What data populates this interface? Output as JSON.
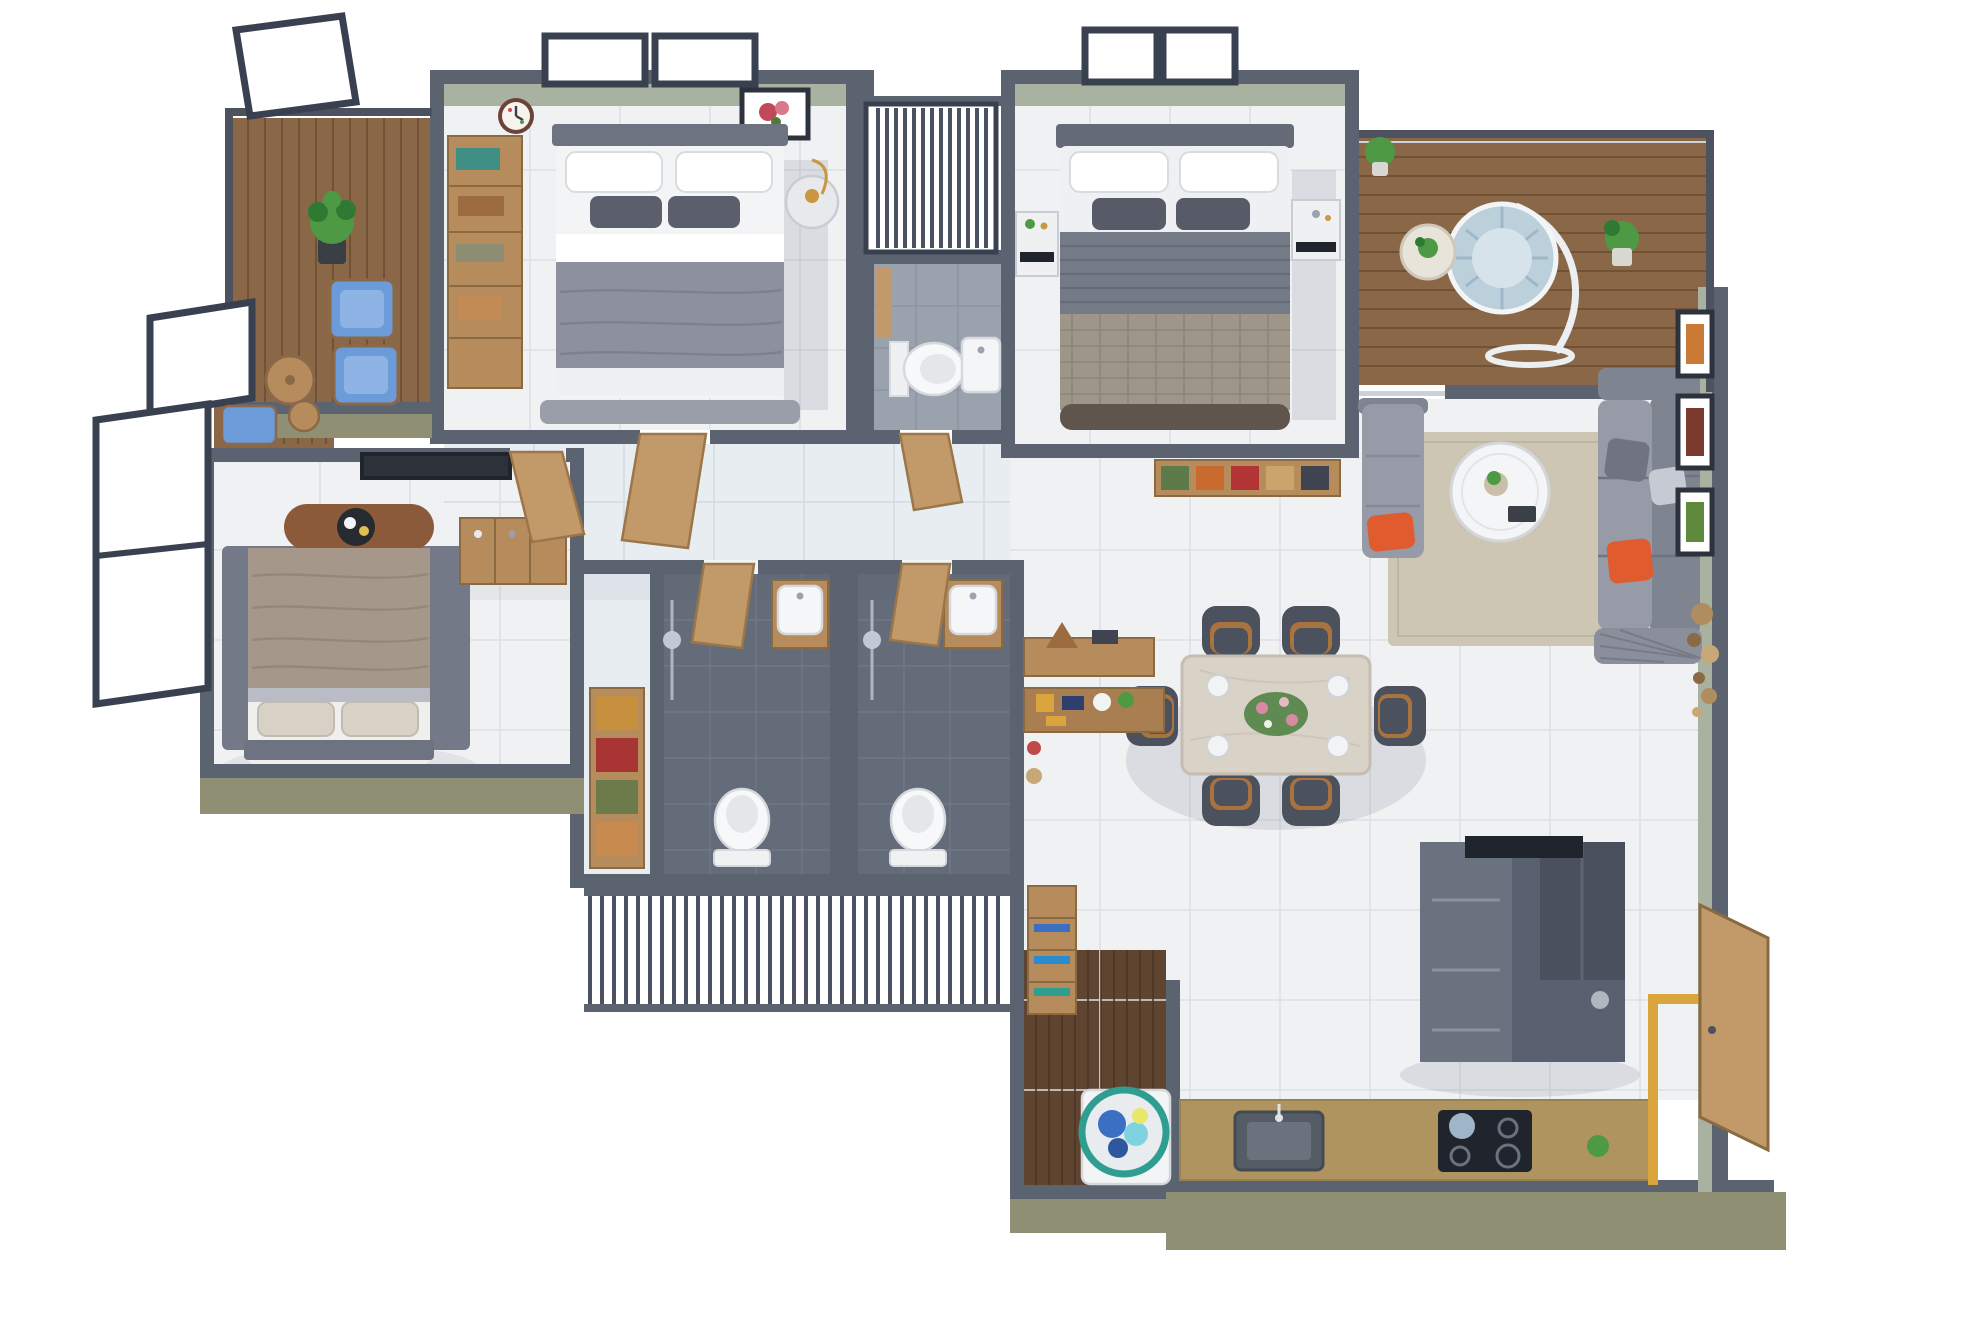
{
  "scene": {
    "type": "3d-floor-plan-render",
    "description": "Top-down 3D rendered floor plan of a 3-bedroom apartment, white background, no text labels",
    "rooms": [
      {
        "id": "bedroom-1",
        "area": "top-left",
        "floor": "light-marble",
        "furniture": [
          "wardrobe-with-shelves",
          "double-bed-gray",
          "round-nightstand",
          "wall-clock",
          "flower-art-frame",
          "two-windows"
        ]
      },
      {
        "id": "balcony-1",
        "area": "top-left-outside",
        "floor": "wood-deck",
        "furniture": [
          "potted-plant",
          "two-blue-lounge-chairs",
          "round-wood-table",
          "dark-railing"
        ]
      },
      {
        "id": "louver-shaft-top",
        "area": "top-center",
        "feature": "vertical-slatted-screen"
      },
      {
        "id": "bathroom-1",
        "area": "top-center",
        "floor": "light-gray-tile",
        "furniture": [
          "toilet",
          "wall-basin",
          "wood-door"
        ]
      },
      {
        "id": "bedroom-2",
        "area": "top-middle",
        "floor": "light-marble",
        "furniture": [
          "double-bed-striped-duvet",
          "white-nightstand",
          "white-vanity",
          "storage-cubbies",
          "two-windows"
        ]
      },
      {
        "id": "balcony-2",
        "area": "top-right",
        "floor": "wood-deck",
        "furniture": [
          "hanging-egg-chair",
          "round-side-table",
          "potted-plants",
          "glass-railing"
        ]
      },
      {
        "id": "living-room",
        "area": "right",
        "floor": "light-marble",
        "furniture": [
          "sectional-sofa",
          "chaise-sofa",
          "round-coffee-table",
          "beige-rug",
          "three-art-frames",
          "wall-plates-decor"
        ]
      },
      {
        "id": "dining",
        "area": "center-right",
        "floor": "light-marble",
        "furniture": [
          "marble-dining-table",
          "six-dark-chairs",
          "flower-centerpiece",
          "plates"
        ]
      },
      {
        "id": "bedroom-3",
        "area": "bottom-left",
        "floor": "light-marble",
        "furniture": [
          "double-bed-khaki",
          "foot-bench-with-tray",
          "tv-panel",
          "dresser",
          "dark-rug"
        ]
      },
      {
        "id": "balcony-3",
        "area": "left",
        "floor": "wood-deck",
        "furniture": [
          "blue-chair",
          "round-stool",
          "tilted-glass-windows"
        ]
      },
      {
        "id": "bathroom-2",
        "area": "center",
        "floor": "dark-gray-tile",
        "furniture": [
          "toilet",
          "wood-vanity-basin",
          "shower-set",
          "towel-shelf"
        ]
      },
      {
        "id": "bathroom-3",
        "area": "center",
        "floor": "dark-gray-tile",
        "furniture": [
          "toilet",
          "wood-vanity-basin",
          "shower-set"
        ]
      },
      {
        "id": "passage",
        "area": "center-right",
        "floor": "light-marble",
        "furniture": [
          "console-table-with-pyramid-lamp",
          "decor-shelf"
        ]
      },
      {
        "id": "louver-screen-bottom",
        "area": "bottom-center",
        "feature": "vertical-slatted-screen"
      },
      {
        "id": "utility",
        "area": "bottom-center",
        "floor": "dark-wood-plank",
        "furniture": [
          "slat-bookshelf",
          "washing-machine",
          "laundry-basket"
        ]
      },
      {
        "id": "kitchen",
        "area": "bottom-right",
        "floor": "light-marble",
        "furniture": [
          "tan-counter",
          "inset-sink",
          "gas-hob-with-kettle",
          "tall-dark-cabinets-island",
          "small-plant"
        ]
      },
      {
        "id": "foyer",
        "area": "bottom-right-corner",
        "floor": "light-marble",
        "furniture": [
          "open-wood-entrance-door",
          "yellow-door-frame"
        ]
      }
    ],
    "palette": {
      "wall": "#5b6270",
      "wall_dark": "#4c535f",
      "olive": "#8f8f73",
      "olive_light": "#a6a68a",
      "sage": "#a9b2a0",
      "frame": "#394050",
      "marble": "#f0f1f3",
      "marble_blue": "#e8edf2",
      "floorline": "#dde0e4",
      "wood_deck": "#8a6747",
      "wood_plank_line": "#6b4c31",
      "wood_furniture": "#b78c5c",
      "wood_door": "#c29a6a",
      "tile_dark": "#656c79",
      "tile_grout": "#717885",
      "tile_light": "#9aa2ae",
      "duvet_gray": "#8d919d",
      "duvet_khaki": "#a5988a",
      "pillow_dark": "#5a5f6b",
      "linen_white": "#f3f4f6",
      "sofa_gray": "#969ba7",
      "sofa_dark": "#7e8490",
      "accent_orange": "#e05b2d",
      "chair_dark": "#4b525e",
      "chair_tan": "#a9733f",
      "table_marble": "#d9d2c7",
      "counter_tan": "#b0945f",
      "appliance_dark": "#20242c",
      "island_gray": "#596070",
      "rug_beige": "#ccc6b2",
      "rug_gray": "#747987",
      "blue_chair": "#6b9bd8",
      "plant_green": "#4e9a44",
      "plant_dark": "#2f7a33",
      "basket_teal": "#2f9d8f",
      "clothes_blue": "#3b6fc4",
      "clothes_cyan": "#7fd3e0",
      "yellow_trim": "#d9a53c",
      "gold": "#c9973f"
    }
  }
}
